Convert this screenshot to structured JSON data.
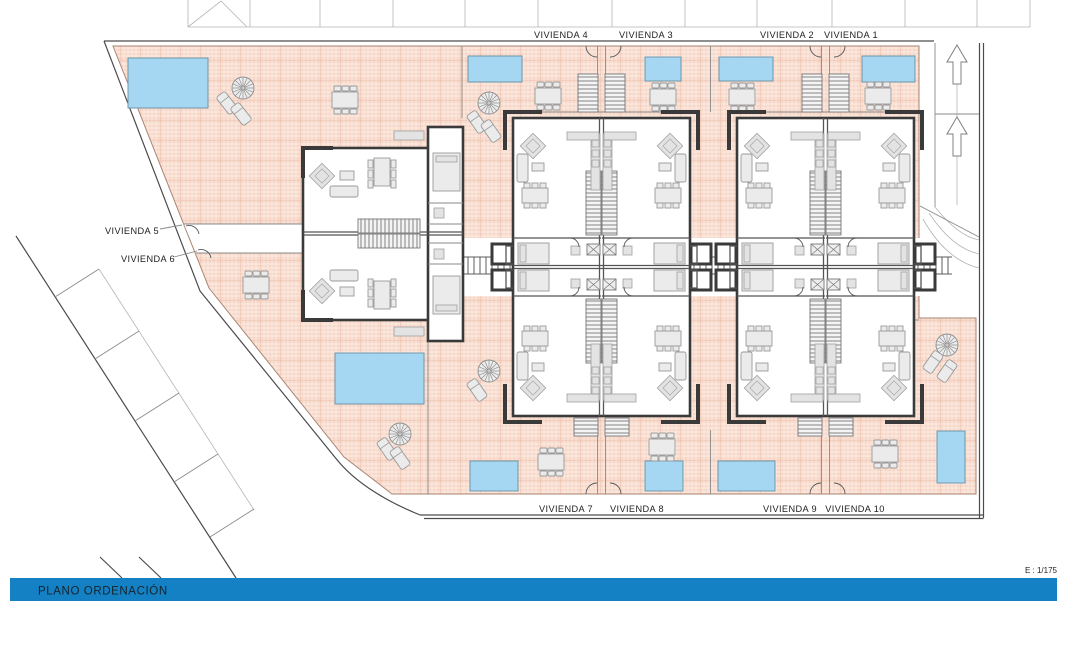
{
  "viviendas": [
    {
      "label": "VIVIENDA 1"
    },
    {
      "label": "VIVIENDA 2"
    },
    {
      "label": "VIVIENDA 3"
    },
    {
      "label": "VIVIENDA 4"
    },
    {
      "label": "VIVIENDA 5"
    },
    {
      "label": "VIVIENDA 6"
    },
    {
      "label": "VIVIENDA 7"
    },
    {
      "label": "VIVIENDA 8"
    },
    {
      "label": "VIVIENDA 9"
    },
    {
      "label": "VIVIENDA 10"
    }
  ],
  "footer": {
    "title": "PLANO ORDENACIÓN",
    "bar_color": "#1581c5",
    "text_color": "#14232c"
  },
  "scale_label": "E : 1/175",
  "colors": {
    "terrace": "#f6d7c8",
    "pool": "#a5d7f2",
    "wall": "#3a3a3a"
  }
}
